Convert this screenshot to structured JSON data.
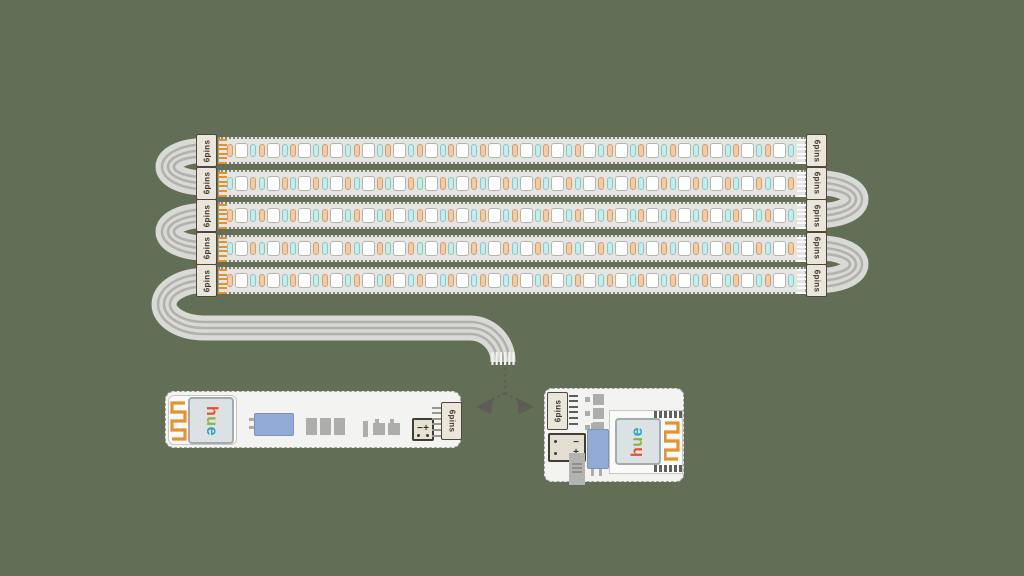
{
  "background_color": "#626e55",
  "connector": {
    "label": "6pins",
    "pin_count": 6
  },
  "strip_assembly": {
    "rows": 5,
    "led_groups_per_row": 18,
    "row_patterns": [
      "warm-white-cool",
      "cool-white-warm",
      "warm-white-cool",
      "cool-white-warm",
      "warm-white-cool"
    ],
    "led_colors": {
      "warm": "#f5cba5",
      "white": "#ffffff",
      "cool": "#c6edeb"
    },
    "pin_color_left": "#e2912f",
    "pin_color_right": "#fafaf7"
  },
  "cable": {
    "color": "#d9d9d6",
    "stripe_color": "#b1b1ae",
    "end_teeth_color": "#f2f2ef"
  },
  "arrow": {
    "color": "#5d5d56"
  },
  "controllers": {
    "board_color": "#f3f3f1",
    "chip_color": "#92aad6",
    "antenna_color": "#e8922e",
    "hue_logo": [
      {
        "letter": "h",
        "color": "#e0512e"
      },
      {
        "letter": "u",
        "color": "#8cb440"
      },
      {
        "letter": "e",
        "color": "#2ba3c6"
      }
    ],
    "terminal": {
      "minus": "−",
      "plus": "+"
    },
    "left_board_connector_label": "6pins",
    "right_board_connector_label": "6pins"
  }
}
